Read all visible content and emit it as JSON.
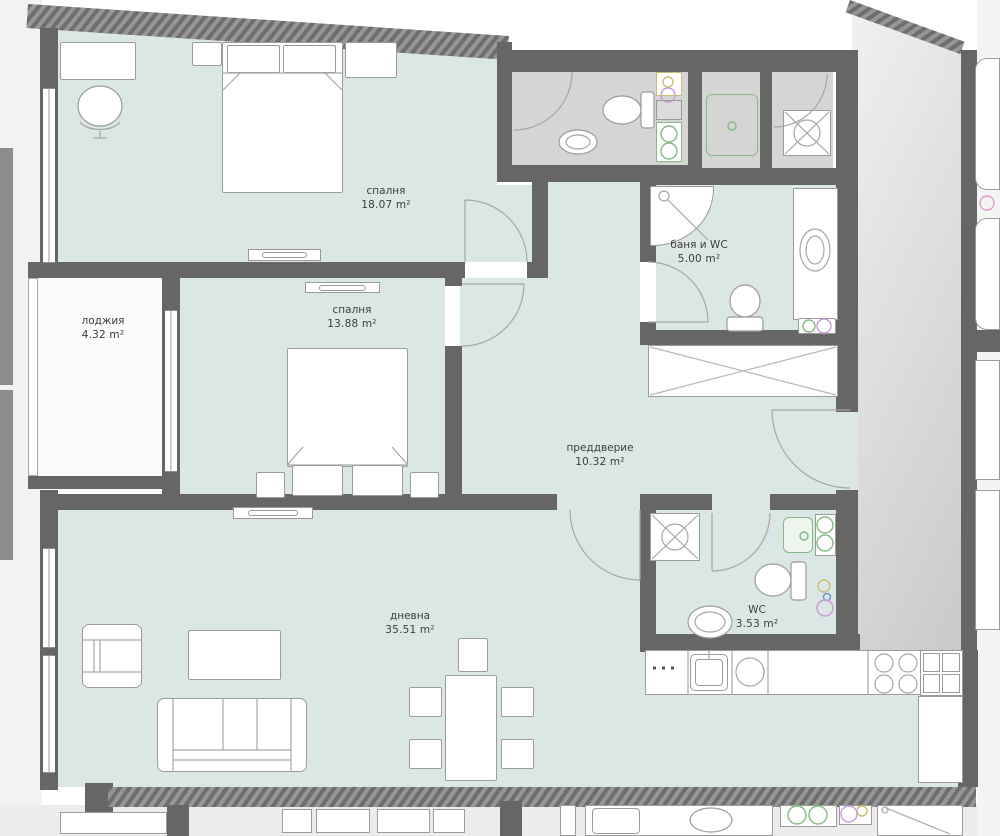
{
  "rooms": [
    {
      "name": "спалня",
      "area": "18.07 m²"
    },
    {
      "name": "спалня",
      "area": "13.88 m²"
    },
    {
      "name": "лоджия",
      "area": "4.32 m²"
    },
    {
      "name": "баня и WC",
      "area": "5.00 m²"
    },
    {
      "name": "преддверие",
      "area": "10.32 m²"
    },
    {
      "name": "дневна",
      "area": "35.51 m²"
    },
    {
      "name": "WC",
      "area": "3.53 m²"
    }
  ],
  "colors": {
    "room_fill": "#dbe7e4",
    "neighbor_fill": "#d5d5d4",
    "wall": "#666665",
    "outside": "#f2f2f1",
    "line": "#a6a6a6",
    "text": "#3d3d3d",
    "accent_green": "#84b884",
    "accent_purple": "#c79ad6",
    "accent_blue": "#6b93cc",
    "accent_yellow": "#c9bd72",
    "accent_pink": "#e39ad0"
  },
  "legend": {
    "fixtures": [
      "bed",
      "wardrobe",
      "sofa",
      "armchair",
      "coffee-table",
      "dining-table",
      "chair",
      "desk",
      "office-chair",
      "toilet",
      "sink",
      "shower",
      "bathtub",
      "washing-machine",
      "kitchen-counter",
      "cooktop",
      "fridge",
      "radiator",
      "ventilation-shaft",
      "door-swing",
      "window",
      "radiator"
    ]
  }
}
